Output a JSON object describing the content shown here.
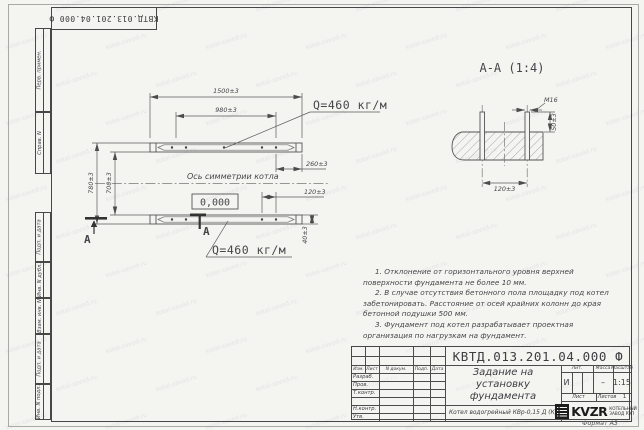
{
  "sheet": {
    "watermark": "kotel-zavod.ru",
    "format_label": "Формат А3",
    "stamp_vertical": "КВТД.013.201.04.000 Ф"
  },
  "frame_labels": {
    "perv": "Перв. примен.",
    "sprav": "Справ. N",
    "podp1": "Подп. и дата",
    "inv_dubl": "Инв. N дубл.",
    "vzam": "Взам. инв. N",
    "podp2": "Подп. и дата",
    "inv_podl": "Инв. N подл."
  },
  "plan": {
    "dims": {
      "len_outer": "1500±3",
      "len_inner": "980±3",
      "width_outer": "780±3",
      "width_inner": "700±3",
      "end_offset": "260±3",
      "bolt_gap": "120±3",
      "rail_height": "40±3"
    },
    "axis_label": "Ось симметрии котла",
    "level_mark": "0,000",
    "load_top": "Q=460 кг/м",
    "load_bottom": "Q=460 кг/м",
    "section_letter_1": "А",
    "section_letter_2": "А"
  },
  "section": {
    "title": "А-А (1:4)",
    "bolt_thread": "М16",
    "bolt_height": "50±3",
    "bolt_spacing": "120±3"
  },
  "notes": [
    "1. Отклонение от горизонтального уровня верхней поверхности фундамента не более 10 мм.",
    "2. В случае отсутствия бетонного пола площадку под котел забетонировать. Расстояние от осей крайних колонн до края бетонной подушки 500 мм.",
    "3. Фундамент под котел разрабатывает проектная организация по нагрузкам на фундамент."
  ],
  "titleblock": {
    "doc_number": "КВТД.013.201.04.000 Ф",
    "doc_title": "Задание на установку фундамента",
    "product": "Котел водогрейный КВр-0,15 Д (К)",
    "header_cols": [
      "Изм.",
      "Лист",
      "N докум.",
      "Подп.",
      "Дата"
    ],
    "row_labels": [
      "Разраб.",
      "Пров.",
      "Т.контр.",
      "Н.контр.",
      "Утв."
    ],
    "lit_label": "Лит.",
    "mass_label": "Масса",
    "scale_label": "Масштаб",
    "lit_value": "И",
    "mass_value": "–",
    "scale_value": "1:15",
    "sheet_label": "Лист",
    "sheets_label": "Листов",
    "sheets_value": "1",
    "logo_text": "KVZR",
    "logo_sub1": "КОТЕЛЬНЫЙ",
    "logo_sub2": "ЗАВОД РЭП"
  }
}
